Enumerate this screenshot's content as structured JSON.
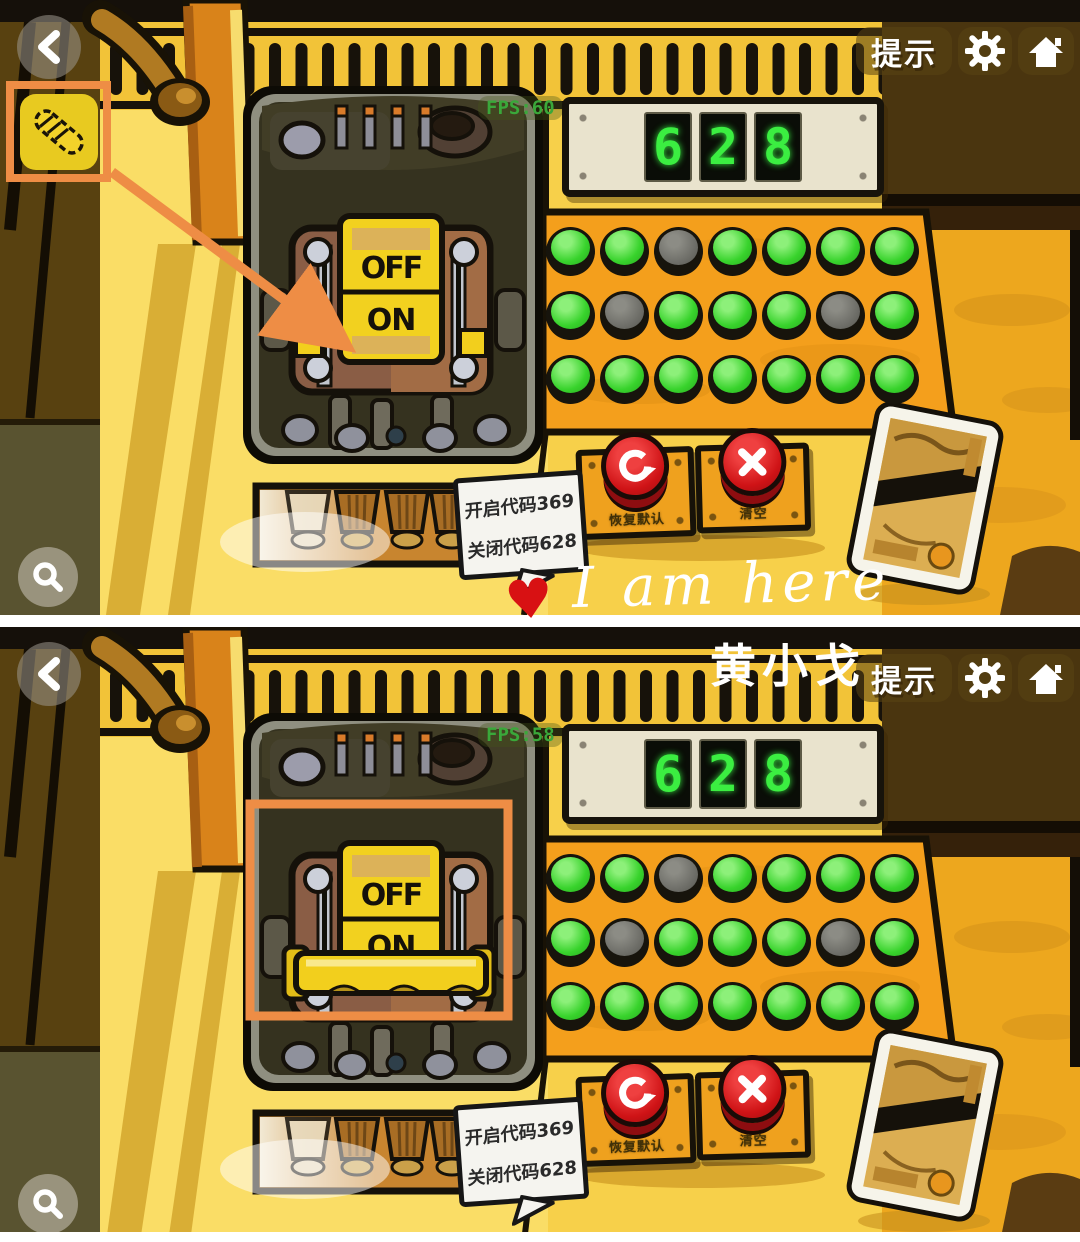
{
  "watermarks": {
    "heart": "♥",
    "handwriting": "I am here",
    "author": "黄小戈"
  },
  "switch_labels": {
    "off": "OFF",
    "on": "ON"
  },
  "icons": {
    "back": "chevron-left-icon",
    "settings": "gear-icon",
    "home": "home-icon",
    "magnify": "magnifier-icon",
    "reset": "circular-arrow-icon",
    "clear": "cross-icon",
    "inventory_item": "fuse-item-icon"
  },
  "colors": {
    "highlight_orange": "#ee8d45",
    "button_green": "#38d32c",
    "button_gray": "#70706a",
    "digit_green": "#3bee41",
    "red_button": "#d21417",
    "machine_yellow": "#f7d04a",
    "panel_orange": "#f49f1c"
  },
  "panels": {
    "top": {
      "fps_label": "FPS:60",
      "hint_label": "提示",
      "display_digits": [
        "6",
        "2",
        "8"
      ],
      "button_grid": [
        [
          "green",
          "green",
          "gray",
          "green",
          "green",
          "green",
          "green"
        ],
        [
          "green",
          "gray",
          "green",
          "green",
          "green",
          "gray",
          "green"
        ],
        [
          "green",
          "green",
          "green",
          "green",
          "green",
          "green",
          "green"
        ]
      ],
      "reset_label": "恢复默认",
      "clear_label": "清空",
      "note_lines": [
        "开启代码369",
        "关闭代码628"
      ],
      "switch_state": "OFF",
      "annotations": [
        "inventory-item-highlight",
        "arrow-to-switch"
      ]
    },
    "bottom": {
      "fps_label": "FPS:58",
      "hint_label": "提示",
      "display_digits": [
        "6",
        "2",
        "8"
      ],
      "button_grid": [
        [
          "green",
          "green",
          "gray",
          "green",
          "green",
          "green",
          "green"
        ],
        [
          "green",
          "gray",
          "green",
          "green",
          "green",
          "gray",
          "green"
        ],
        [
          "green",
          "green",
          "green",
          "green",
          "green",
          "green",
          "green"
        ]
      ],
      "reset_label": "恢复默认",
      "clear_label": "清空",
      "note_lines": [
        "开启代码369",
        "关闭代码628"
      ],
      "switch_state": "ON",
      "annotations": [
        "switch-highlight-box"
      ]
    }
  }
}
